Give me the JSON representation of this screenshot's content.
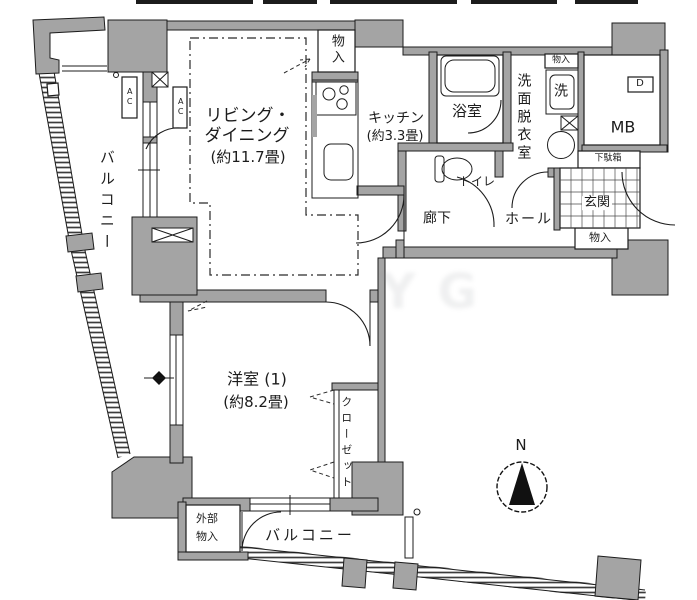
{
  "colors": {
    "wall": "#a4a4a4",
    "line": "#1c1c1c",
    "background": "#ffffff"
  },
  "rooms": {
    "living_dining": {
      "name_line1": "リビング・",
      "name_line2": "ダイニング",
      "size": "(約11.7畳)"
    },
    "kitchen": {
      "name": "キッチン",
      "size": "(約3.3畳)"
    },
    "western_room": {
      "name": "洋室 (1)",
      "size": "(約8.2畳)"
    },
    "bathroom": {
      "name": "浴室"
    },
    "washroom": {
      "name": "洗面脱衣室"
    },
    "toilet": {
      "name": "トイレ"
    },
    "hallway": {
      "name": "廊下"
    },
    "hall": {
      "name": "ホール"
    },
    "entrance": {
      "name": "玄関"
    },
    "closet": {
      "name": "クローゼット"
    },
    "balcony_left": {
      "name": "バルコニー"
    },
    "balcony_bottom": {
      "name": "バルコニー"
    },
    "external_storage": {
      "name_line1": "外部",
      "name_line2": "物入"
    },
    "meter_box": {
      "name": "MB"
    }
  },
  "fixtures": {
    "washer": "洗",
    "shoe_cabinet": "下駄箱",
    "storage_top": "物入",
    "storage_washroom": "物入",
    "storage_entrance": "物入",
    "ac_unit_1": "AC",
    "ac_unit_2": "AC",
    "duct": "D"
  },
  "compass": {
    "north": "N"
  },
  "watermark": "YG"
}
